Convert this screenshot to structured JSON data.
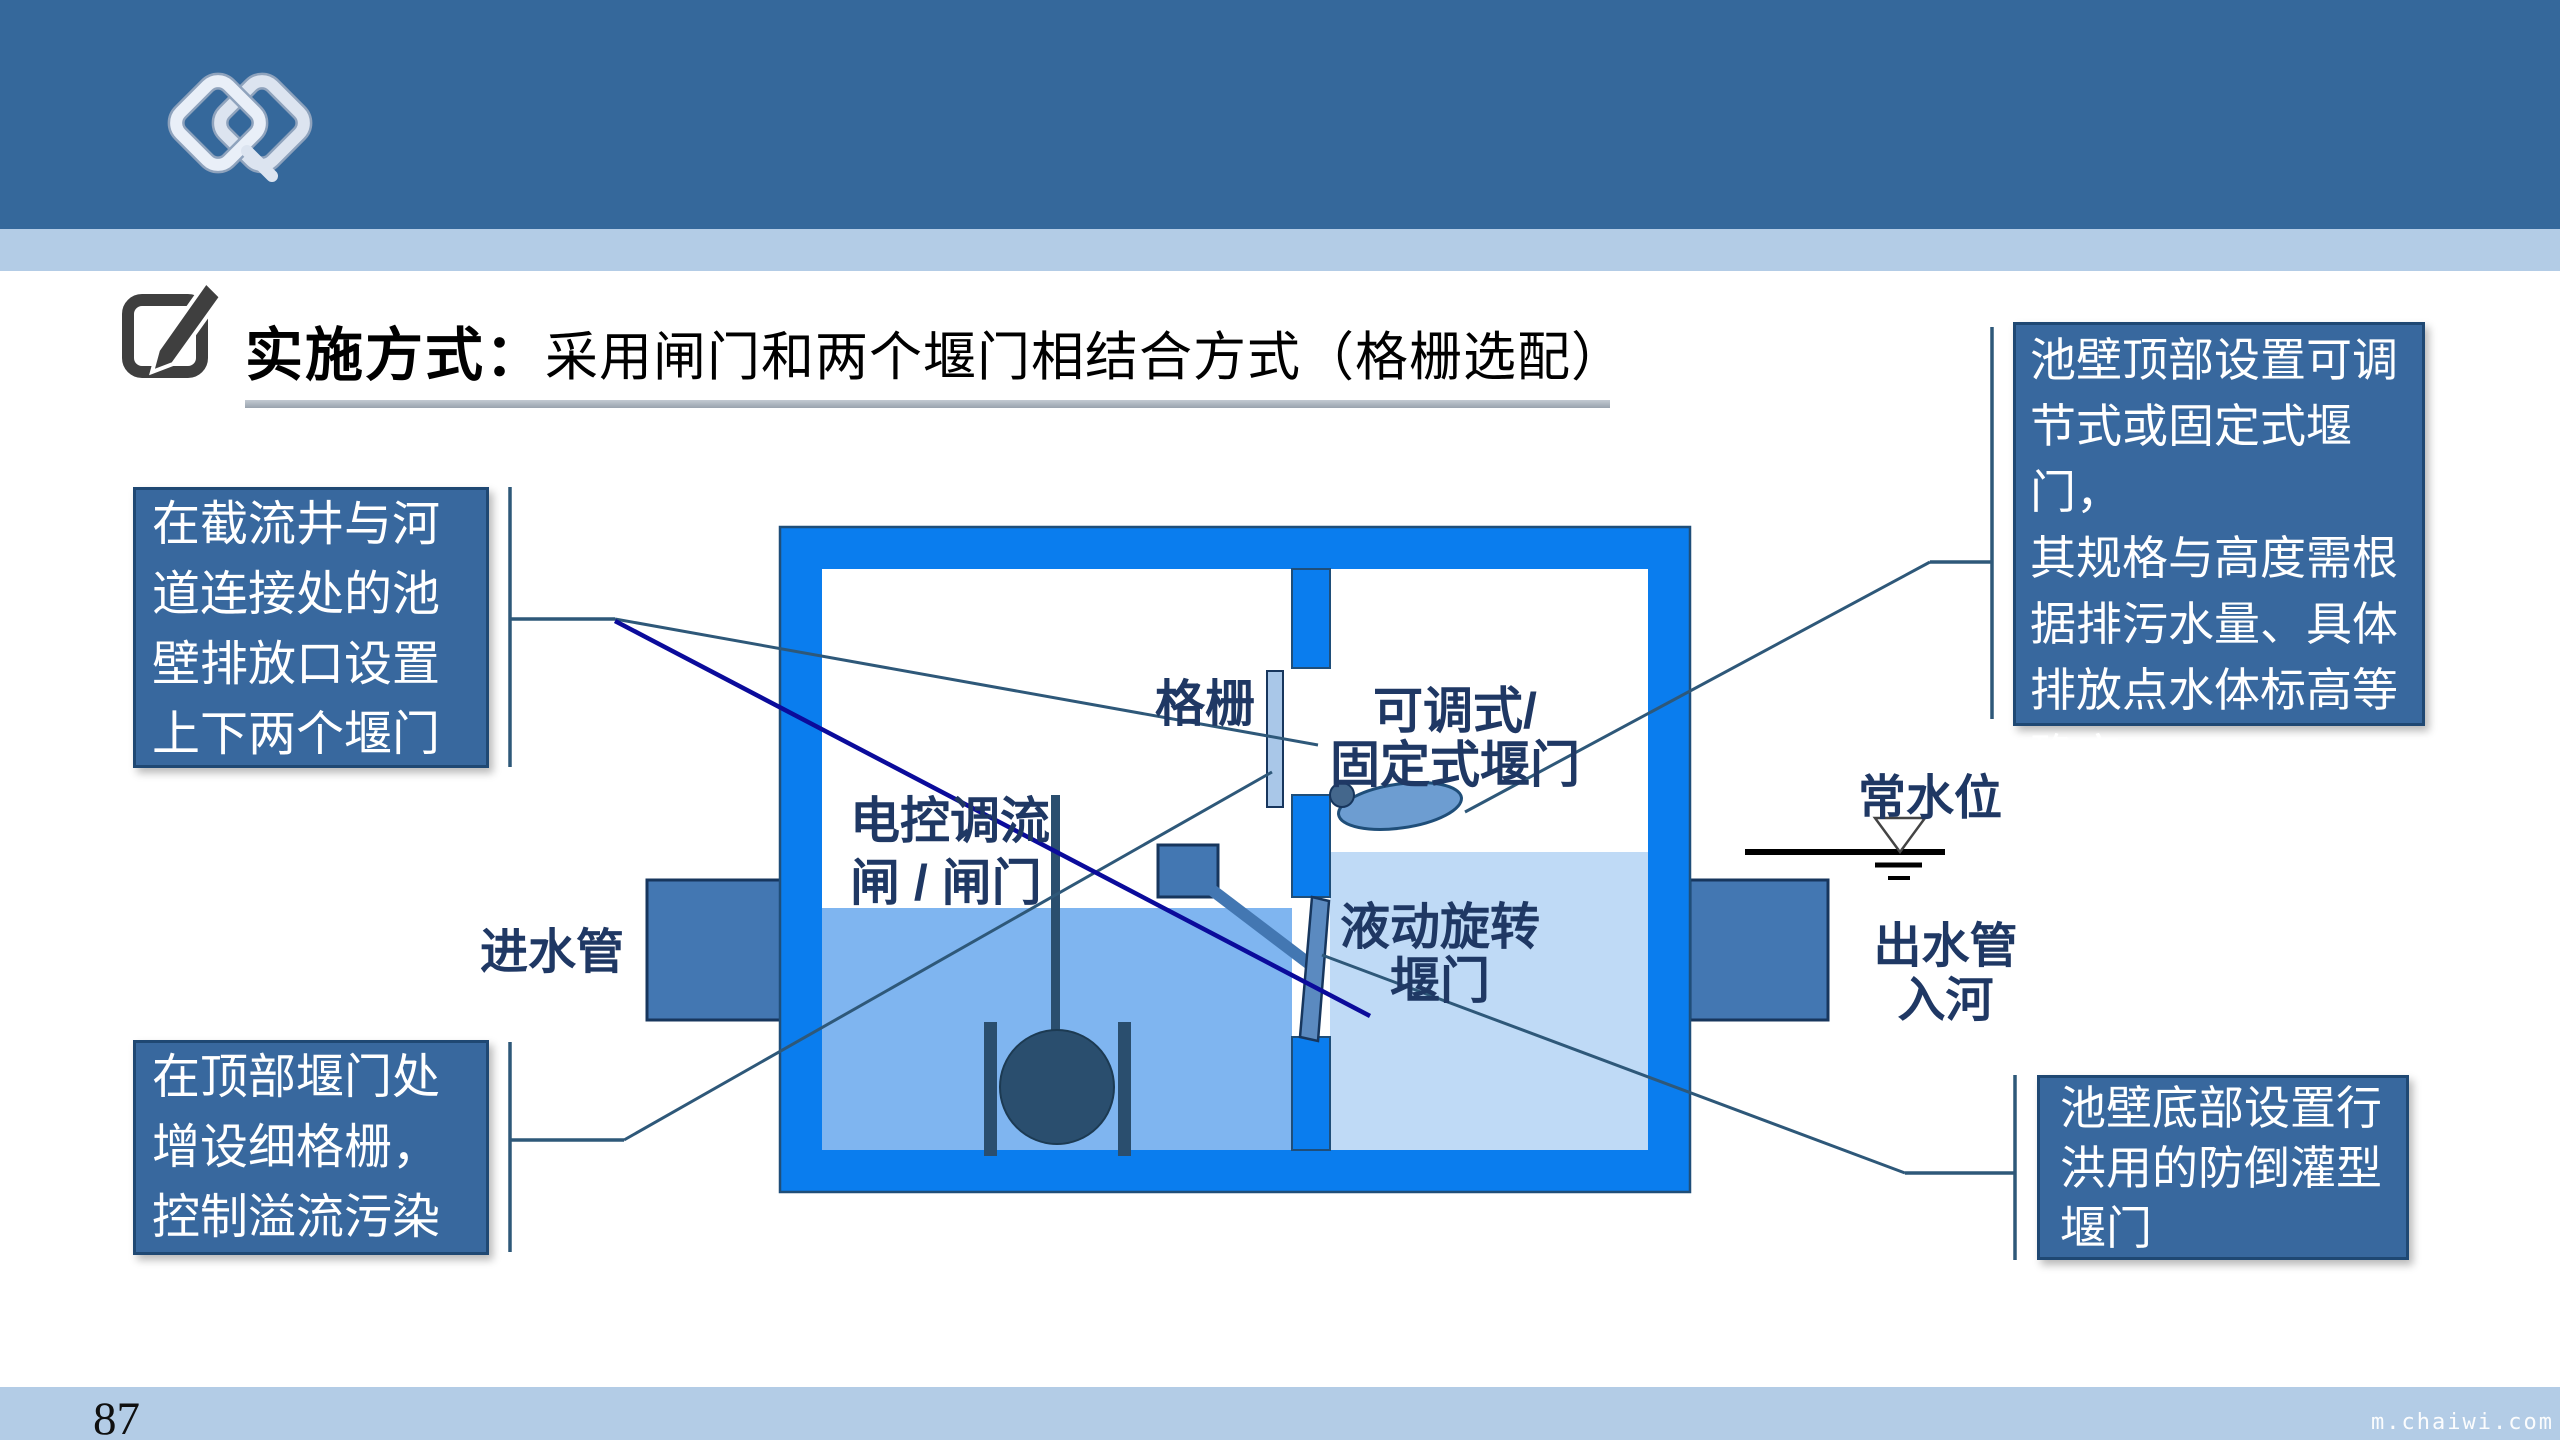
{
  "header": {
    "bar_color": "#35689B",
    "stripe_color": "#B3CCE6",
    "logo": "interlocked-diamonds"
  },
  "title": {
    "prefix": "实施方式：",
    "text": "采用闸门和两个堰门相结合方式（格栅选配）",
    "icon": "pencil-edit-icon"
  },
  "callouts": {
    "left_top": "在截流井与河\n道连接处的池\n壁排放口设置\n上下两个堰门",
    "left_bottom": "在顶部堰门处\n增设细格栅，\n控制溢流污染",
    "right_top": "池壁顶部设置可调\n节式或固定式堰门，\n其规格与高度需根\n据排污水量、具体\n排放点水体标高等\n确定。",
    "right_bottom": "池壁底部设置行\n洪用的防倒灌型\n堰门"
  },
  "diagram": {
    "labels": {
      "grating": "格栅",
      "top_weir": "可调式/\n固定式堰门",
      "control_gate": "电控调流\n闸 / 闸门",
      "rotating_weir": "液动旋转\n堰门",
      "inlet_pipe": "进水管",
      "outlet_pipe": "出水管\n入河",
      "normal_water_level": "常水位"
    },
    "colors": {
      "tank_wall": "#0A7DEE",
      "tank_outline": "#1F4E79",
      "left_water": "#7FB5F0",
      "right_water": "#BFDAF6",
      "steel_part": "#4377B2",
      "weir_ellipse": "#6D9DD1",
      "grating_bar": "#A9C7E8",
      "float_ball": "#2A4E6E",
      "label_text": "#1F3864",
      "leader_line": "#2E5879",
      "leader_line_navy": "#0B0B9B",
      "callout_fill": "#38689E",
      "callout_border": "#1F4873"
    }
  },
  "footer": {
    "page_number": "87",
    "watermark": "m.chaiwi.com"
  }
}
